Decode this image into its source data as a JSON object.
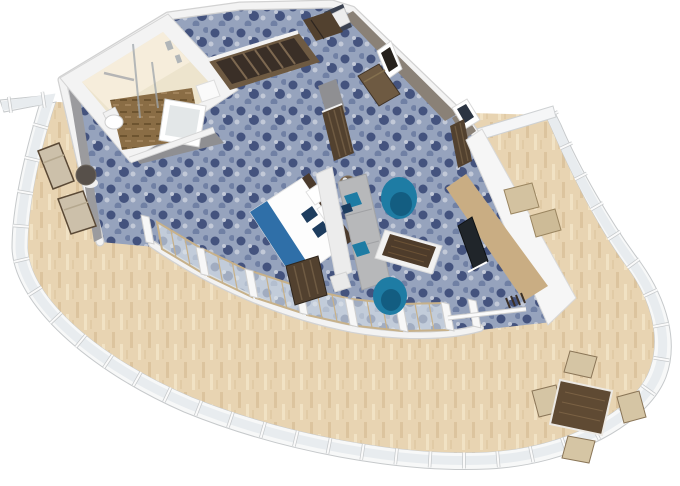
{
  "meta": {
    "title": "aft-suite-3d-floorplan-render",
    "view": "isometric-3d-floorplan",
    "width_px": 680,
    "height_px": 486
  },
  "colors": {
    "bg": "#ffffff",
    "hull_band": "#f7f8f8",
    "hull_edge": "#c6c9cb",
    "hull_glass": "#e8ecef",
    "deck_base": "#e8d4b2",
    "deck_plank": "#dcc49e",
    "deck_plank_light": "#f1e2c4",
    "carpet_base": "#96a3bd",
    "carpet_dark": "#44537e",
    "carpet_mid": "#7080a4",
    "carpet_light": "#c2c9d8",
    "wall_white": "#f3f3f3",
    "wall_edge": "#d2d2d2",
    "wall_gray": "#8f8f92",
    "wall_taupe": "#8a8177",
    "wall_navy": "#3c4352",
    "bath_wall": "#ede4cd",
    "bath_wall_lit": "#f7efdd",
    "bath_floor_base": "#8a6d45",
    "bath_floor_dark": "#6d5430",
    "bath_floor_light": "#a0825a",
    "fixture_white": "#ffffff",
    "tub_inner": "#e3e7e8",
    "wood_dark": "#52412f",
    "wood_mid": "#6e5a42",
    "wood_tan": "#c9ad83",
    "bed_white": "#fdfdfd",
    "bed_blue": "#2f6fa8",
    "pillow_navy": "#1d3c5e",
    "headboard": "#4a3a2c",
    "sofa_gray": "#b7b8ba",
    "sofa_seat": "#c9cacc",
    "teal": "#1e7ca4",
    "teal_dark": "#125a7d",
    "table_trim": "#f1f1f1",
    "table_wood": "#4e3c2b",
    "counter_white": "#f6f6f6",
    "tv_black": "#20252a",
    "lounger_beige": "#ccc0aa",
    "lounger_frame": "#5a4936",
    "door_frame": "#c7b18a",
    "door_glass": "rgba(224,232,237,0.6)",
    "divider_white": "#f5f6f7",
    "stool_tan": "#d3c2a0",
    "dining_wood": "#5f4a33",
    "chair_tan": "#d5c5a4"
  },
  "scene": {
    "rooms": [
      {
        "name": "bathroom",
        "furniture": [
          "toilet",
          "bathtub",
          "glass-shower",
          "towel-bar",
          "vanity"
        ]
      },
      {
        "name": "wardrobe-corridor",
        "furniture": [
          "open-wardrobe",
          "upper-cabinet",
          "bar-cabinet"
        ]
      },
      {
        "name": "entry-hall",
        "furniture": [
          "entry-door",
          "bench",
          "artwork-frame",
          "artwork-frame",
          "window"
        ]
      },
      {
        "name": "bedroom",
        "furniture": [
          "double-bed",
          "headboard",
          "pillows",
          "bed-runner",
          "luggage-bench",
          "privacy-partition"
        ]
      },
      {
        "name": "living-area",
        "furniture": [
          "sofa",
          "coffee-table",
          "armchair",
          "armchair",
          "side-table",
          "media-counter",
          "tv",
          "luggage-rack"
        ]
      },
      {
        "name": "side-balcony",
        "furniture": [
          "lounger",
          "lounger",
          "round-table"
        ]
      },
      {
        "name": "aft-balcony",
        "furniture": [
          "dining-table",
          "dining-chair",
          "dining-chair",
          "dining-chair",
          "dining-chair",
          "bar-stool",
          "bar-stool",
          "sliding-glass-doors",
          "hull-railing"
        ]
      }
    ]
  }
}
